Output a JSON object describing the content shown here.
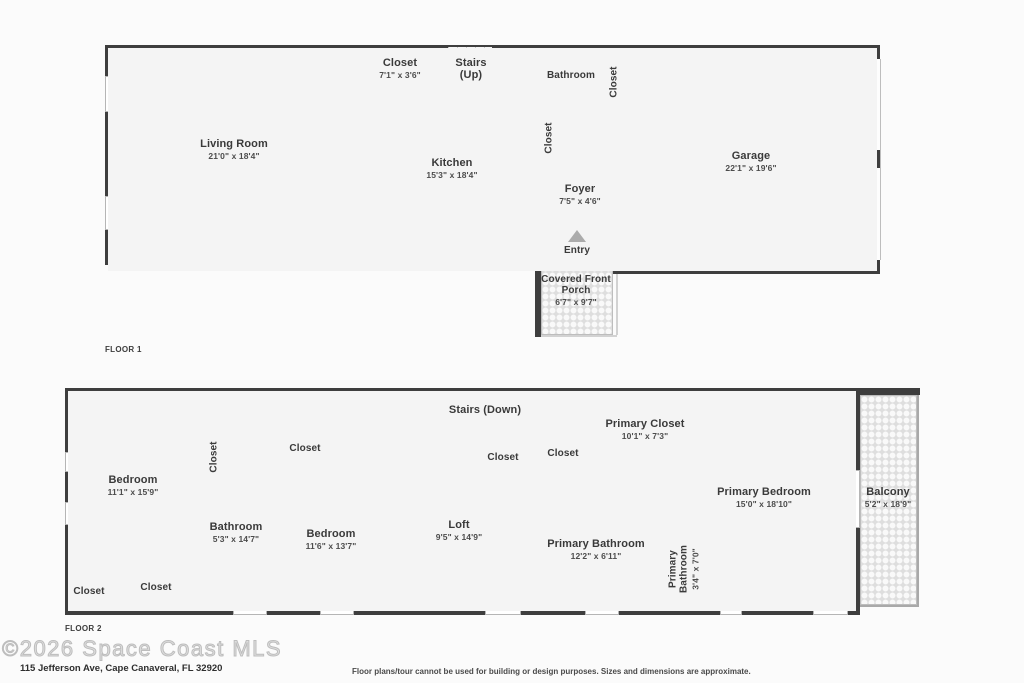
{
  "meta": {
    "wall_color": "#3e3e3e",
    "room_fill": "#f4f4f4",
    "background": "#fbfbfb"
  },
  "floor1": {
    "label": "FLOOR 1",
    "rooms": {
      "living_room": {
        "name": "Living Room",
        "dims": "21'0\" x 18'4\""
      },
      "closet_top": {
        "name": "Closet",
        "dims": "7'1\" x 3'6\""
      },
      "stairs": {
        "name": "Stairs (Up)",
        "dims": ""
      },
      "kitchen": {
        "name": "Kitchen",
        "dims": "15'3\" x 18'4\""
      },
      "bathroom": {
        "name": "Bathroom",
        "dims": ""
      },
      "closet_hall": {
        "name": "Closet",
        "dims": ""
      },
      "closet_foyer": {
        "name": "Closet",
        "dims": ""
      },
      "foyer": {
        "name": "Foyer",
        "dims": "7'5\" x 4'6\""
      },
      "garage": {
        "name": "Garage",
        "dims": "22'1\" x 19'6\""
      },
      "entry": {
        "name": "Entry",
        "dims": ""
      },
      "porch": {
        "name": "Covered Front Porch",
        "dims": "6'7\" x 9'7\""
      }
    }
  },
  "floor2": {
    "label": "FLOOR 2",
    "rooms": {
      "bedroom1": {
        "name": "Bedroom",
        "dims": "11'1\" x 15'9\""
      },
      "closet_bedroom1": {
        "name": "Closet",
        "dims": ""
      },
      "bathroom": {
        "name": "Bathroom",
        "dims": "5'3\" x 14'7\""
      },
      "closet_bedroom2": {
        "name": "Closet",
        "dims": ""
      },
      "bedroom2": {
        "name": "Bedroom",
        "dims": "11'6\" x 13'7\""
      },
      "closet_left_small": {
        "name": "Closet",
        "dims": ""
      },
      "closet_left": {
        "name": "Closet",
        "dims": ""
      },
      "stairs": {
        "name": "Stairs (Down)",
        "dims": ""
      },
      "closet_hall_1": {
        "name": "Closet",
        "dims": ""
      },
      "closet_hall_2": {
        "name": "Closet",
        "dims": ""
      },
      "primary_closet": {
        "name": "Primary Closet",
        "dims": "10'1\" x 7'3\""
      },
      "loft": {
        "name": "Loft",
        "dims": "9'5\" x 14'9\""
      },
      "primary_bathroom": {
        "name": "Primary Bathroom",
        "dims": "12'2\" x 6'11\""
      },
      "primary_bathroom_small": {
        "name": "Primary Bathroom",
        "dims": "3'4\" x 7'0\""
      },
      "primary_bedroom": {
        "name": "Primary Bedroom",
        "dims": "15'0\" x 18'10\""
      },
      "balcony": {
        "name": "Balcony",
        "dims": "5'2\" x 18'9\""
      }
    }
  },
  "footer": {
    "watermark": "©2026 Space Coast MLS",
    "address": "115 Jefferson Ave, Cape Canaveral, FL 32920",
    "disclaimer": "Floor plans/tour cannot be used for building or design purposes. Sizes and dimensions are approximate."
  }
}
